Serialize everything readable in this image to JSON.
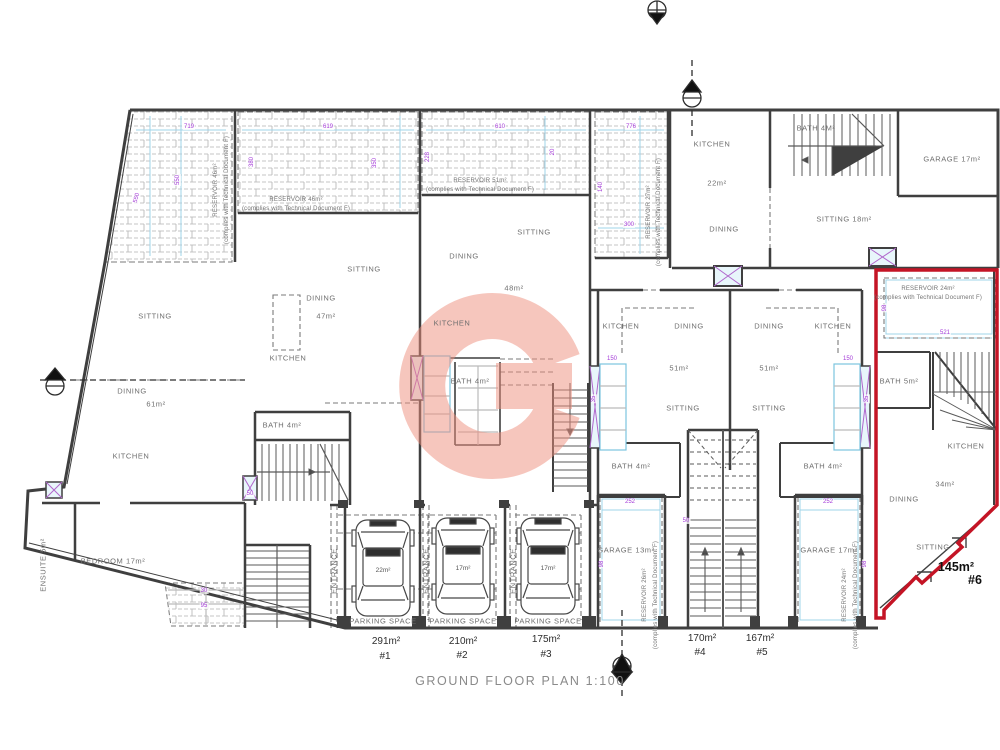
{
  "plan": {
    "title": "GROUND FLOOR PLAN 1:100"
  },
  "colors": {
    "wall": "#3f3f3f",
    "thin_line": "#6a6a6a",
    "dashed": "#7a7a7a",
    "brick_hatch": "#b3b3b3",
    "cyan_guide": "#9fd4ea",
    "dimension_text": "#a43bd8",
    "red_boundary": "#c41425",
    "watermark": "#ef8f7e",
    "label_text": "#6e6e6e"
  },
  "labels": {
    "rooms": [
      {
        "t": "SITTING",
        "x": 155,
        "y": 316
      },
      {
        "t": "DINING",
        "x": 132,
        "y": 391
      },
      {
        "t": "61m²",
        "x": 156,
        "y": 404
      },
      {
        "t": "KITCHEN",
        "x": 131,
        "y": 456
      },
      {
        "t": "BEDROOM 17m²",
        "x": 113,
        "y": 561
      },
      {
        "t": "ENSUITE 5m²",
        "x": 43,
        "y": 565,
        "r": -90
      },
      {
        "t": "KITCHEN",
        "x": 288,
        "y": 358
      },
      {
        "t": "DINING",
        "x": 321,
        "y": 298
      },
      {
        "t": "47m²",
        "x": 326,
        "y": 316
      },
      {
        "t": "SITTING",
        "x": 364,
        "y": 269
      },
      {
        "t": "BATH 4m²",
        "x": 282,
        "y": 425
      },
      {
        "t": "KITCHEN",
        "x": 452,
        "y": 323
      },
      {
        "t": "DINING",
        "x": 464,
        "y": 256
      },
      {
        "t": "48m²",
        "x": 514,
        "y": 288
      },
      {
        "t": "SITTING",
        "x": 534,
        "y": 232
      },
      {
        "t": "BATH 4m²",
        "x": 470,
        "y": 381
      },
      {
        "t": "KITCHEN",
        "x": 621,
        "y": 326
      },
      {
        "t": "DINING",
        "x": 689,
        "y": 326
      },
      {
        "t": "51m²",
        "x": 679,
        "y": 368
      },
      {
        "t": "SITTING",
        "x": 683,
        "y": 408
      },
      {
        "t": "BATH 4m²",
        "x": 631,
        "y": 466
      },
      {
        "t": "DINING",
        "x": 769,
        "y": 326
      },
      {
        "t": "KITCHEN",
        "x": 833,
        "y": 326
      },
      {
        "t": "51m²",
        "x": 769,
        "y": 368
      },
      {
        "t": "SITTING",
        "x": 769,
        "y": 408
      },
      {
        "t": "BATH 4m²",
        "x": 823,
        "y": 466
      },
      {
        "t": "KITCHEN",
        "x": 712,
        "y": 144
      },
      {
        "t": "22m²",
        "x": 717,
        "y": 183
      },
      {
        "t": "DINING",
        "x": 724,
        "y": 229
      },
      {
        "t": "BATH 4M²",
        "x": 816,
        "y": 128
      },
      {
        "t": "GARAGE 17m²",
        "x": 952,
        "y": 159
      },
      {
        "t": "SITTING 18m²",
        "x": 844,
        "y": 219
      },
      {
        "t": "BATH 5m²",
        "x": 899,
        "y": 381
      },
      {
        "t": "KITCHEN",
        "x": 966,
        "y": 446
      },
      {
        "t": "34m²",
        "x": 945,
        "y": 484
      },
      {
        "t": "DINING",
        "x": 904,
        "y": 499
      },
      {
        "t": "SITTING",
        "x": 933,
        "y": 547
      },
      {
        "t": "GARAGE 13m²",
        "x": 626,
        "y": 550
      },
      {
        "t": "GARAGE 17m²",
        "x": 829,
        "y": 550
      },
      {
        "t": "PARKING SPACE",
        "x": 383,
        "y": 621
      },
      {
        "t": "PARKING SPACE",
        "x": 463,
        "y": 621
      },
      {
        "t": "PARKING SPACE",
        "x": 548,
        "y": 621
      },
      {
        "t": "ENTRANCE",
        "x": 334,
        "y": 571,
        "r": -90
      },
      {
        "t": "ENTRANCE",
        "x": 426,
        "y": 571,
        "r": -90
      },
      {
        "t": "ENTRANCE",
        "x": 513,
        "y": 571,
        "r": -90
      }
    ],
    "car_labels": [
      {
        "t": "22m²",
        "x": 383,
        "y": 571
      },
      {
        "t": "17m²",
        "x": 463,
        "y": 569
      },
      {
        "t": "17m²",
        "x": 548,
        "y": 569
      }
    ],
    "reservoirs": [
      {
        "t": "RESERVOIR 46m²",
        "x": 216,
        "y": 190,
        "r": -90
      },
      {
        "t": "(complies with Technical Document F)",
        "x": 227,
        "y": 190,
        "r": -90
      },
      {
        "t": "RESERVOIR 46m²",
        "x": 296,
        "y": 200
      },
      {
        "t": "(complies with Technical Document F)",
        "x": 296,
        "y": 209
      },
      {
        "t": "RESERVOIR 51m²",
        "x": 480,
        "y": 181
      },
      {
        "t": "(complies with Technical Document F)",
        "x": 480,
        "y": 190
      },
      {
        "t": "RESERVOIR 27m²",
        "x": 649,
        "y": 212,
        "r": -90
      },
      {
        "t": "(complies with Technical Document F)",
        "x": 659,
        "y": 212,
        "r": -90
      },
      {
        "t": "RESERVOIR 24m²",
        "x": 928,
        "y": 289
      },
      {
        "t": "(complies with Technical Document F)",
        "x": 928,
        "y": 298
      },
      {
        "t": "RESERVOIR 26m²",
        "x": 645,
        "y": 595,
        "r": -90
      },
      {
        "t": "(complies with Technical Document F)",
        "x": 656,
        "y": 595,
        "r": -90
      },
      {
        "t": "RESERVOIR 24m²",
        "x": 845,
        "y": 595,
        "r": -90
      },
      {
        "t": "(complies with Technical Document F)",
        "x": 856,
        "y": 595,
        "r": -90
      }
    ],
    "dims": [
      {
        "t": "719",
        "x": 189,
        "y": 127
      },
      {
        "t": "619",
        "x": 328,
        "y": 127
      },
      {
        "t": "610",
        "x": 500,
        "y": 127
      },
      {
        "t": "776",
        "x": 631,
        "y": 127
      },
      {
        "t": "550",
        "x": 178,
        "y": 180,
        "r": -90
      },
      {
        "t": "550",
        "x": 137,
        "y": 198,
        "r": -75
      },
      {
        "t": "380",
        "x": 252,
        "y": 162,
        "r": -90
      },
      {
        "t": "350",
        "x": 375,
        "y": 163,
        "r": -90
      },
      {
        "t": "228",
        "x": 428,
        "y": 157,
        "r": -90
      },
      {
        "t": "20",
        "x": 553,
        "y": 152,
        "r": -90
      },
      {
        "t": "140",
        "x": 601,
        "y": 187,
        "r": -90
      },
      {
        "t": "300",
        "x": 629,
        "y": 225
      },
      {
        "t": "521",
        "x": 945,
        "y": 333
      },
      {
        "t": "98",
        "x": 885,
        "y": 308,
        "r": -90
      },
      {
        "t": "150",
        "x": 612,
        "y": 359
      },
      {
        "t": "35",
        "x": 594,
        "y": 399,
        "r": -90
      },
      {
        "t": "150",
        "x": 848,
        "y": 359
      },
      {
        "t": "35",
        "x": 867,
        "y": 399,
        "r": -90
      },
      {
        "t": "252",
        "x": 630,
        "y": 502
      },
      {
        "t": "252",
        "x": 828,
        "y": 502
      },
      {
        "t": "98",
        "x": 602,
        "y": 564,
        "r": -90
      },
      {
        "t": "98",
        "x": 865,
        "y": 564,
        "r": -90
      },
      {
        "t": "30",
        "x": 204,
        "y": 591
      },
      {
        "t": "95",
        "x": 204,
        "y": 606
      },
      {
        "t": "50",
        "x": 250,
        "y": 494
      },
      {
        "t": "50",
        "x": 686,
        "y": 521
      }
    ],
    "units": [
      {
        "t": "291m²",
        "x": 386,
        "y": 642
      },
      {
        "t": "#1",
        "x": 385,
        "y": 657
      },
      {
        "t": "210m²",
        "x": 463,
        "y": 642
      },
      {
        "t": "#2",
        "x": 462,
        "y": 656
      },
      {
        "t": "175m²",
        "x": 546,
        "y": 640
      },
      {
        "t": "#3",
        "x": 546,
        "y": 655
      },
      {
        "t": "170m²",
        "x": 702,
        "y": 639
      },
      {
        "t": "#4",
        "x": 700,
        "y": 653
      },
      {
        "t": "167m²",
        "x": 760,
        "y": 639
      },
      {
        "t": "#5",
        "x": 762,
        "y": 653
      },
      {
        "t": "145m²",
        "x": 956,
        "y": 567,
        "big": true
      },
      {
        "t": "#6",
        "x": 975,
        "y": 580,
        "big": true
      }
    ]
  }
}
